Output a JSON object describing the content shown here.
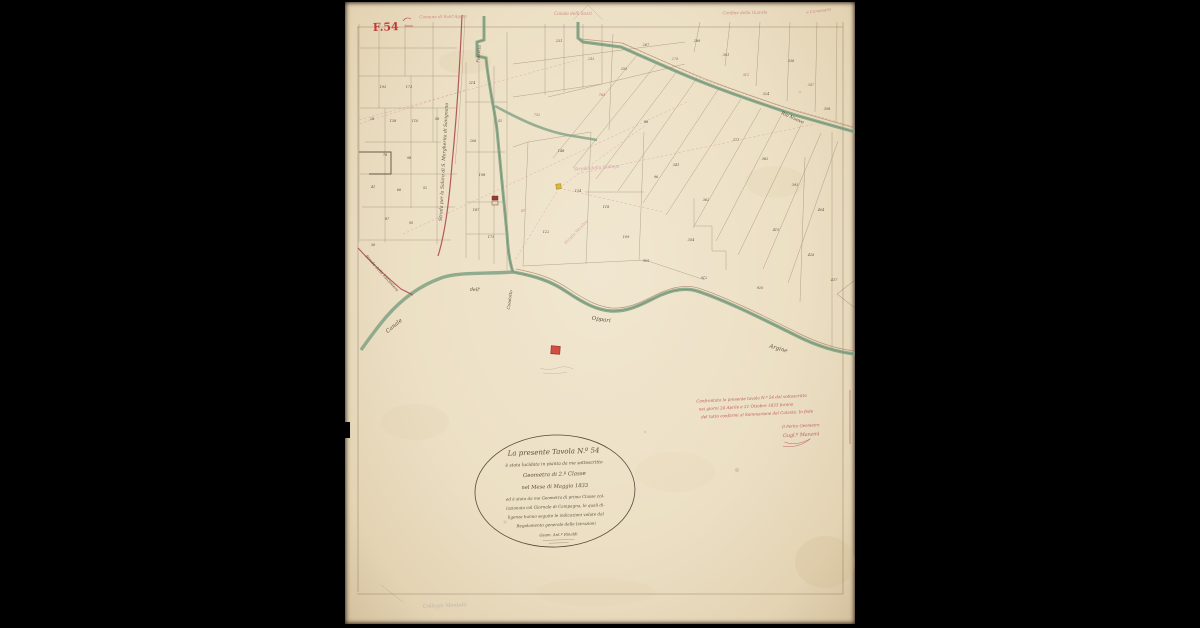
{
  "sheet": {
    "number_label": "F.54",
    "colors": {
      "paper": "#ece0c5",
      "canal": "#7fa184",
      "road": "#a84a52",
      "ink": "#473827",
      "note_red": "#b5484f",
      "pink": "#cf8f9e"
    }
  },
  "edge_notes": [
    "Comune di Sant'Agata",
    "Canale delli Sozzi",
    "Confine della Guarda",
    "e Campagna"
  ],
  "map_labels": {
    "road_salara": "Strada per la Salara di S. Margherita di Savignano",
    "fossetta": "Fossetta",
    "road_falconiera": "Strada della Falconiera",
    "canale": "Canale",
    "dell": "dell'",
    "condotto": "Condotto",
    "oppari": "Oppari",
    "argine": "Argine",
    "rio_nuovo": "Rio Nuovo",
    "gallega": "Strada della Gallega",
    "strada_vecchia": "Strada Vecchia",
    "pencil_note": "Collegio Montalti"
  },
  "parcel_numbers": [
    {
      "t": "193",
      "x": 38,
      "y": 86,
      "c": "k"
    },
    {
      "t": "173",
      "x": 64,
      "y": 86,
      "c": "k"
    },
    {
      "t": "28",
      "x": 27,
      "y": 118,
      "c": "k"
    },
    {
      "t": "138",
      "x": 48,
      "y": 120,
      "c": "k"
    },
    {
      "t": "110",
      "x": 70,
      "y": 120,
      "c": "k"
    },
    {
      "t": "58",
      "x": 92,
      "y": 118,
      "c": "k"
    },
    {
      "t": "78",
      "x": 40,
      "y": 154,
      "c": "k"
    },
    {
      "t": "98",
      "x": 64,
      "y": 157,
      "c": "k"
    },
    {
      "t": "41",
      "x": 28,
      "y": 186,
      "c": "k"
    },
    {
      "t": "66",
      "x": 54,
      "y": 189,
      "c": "k"
    },
    {
      "t": "52",
      "x": 80,
      "y": 187,
      "c": "k"
    },
    {
      "t": "87",
      "x": 42,
      "y": 218,
      "c": "k"
    },
    {
      "t": "95",
      "x": 66,
      "y": 222,
      "c": "k"
    },
    {
      "t": "36",
      "x": 28,
      "y": 244,
      "c": "k"
    },
    {
      "t": "214",
      "x": 127,
      "y": 82,
      "c": "k"
    },
    {
      "t": "206",
      "x": 128,
      "y": 140,
      "c": "k"
    },
    {
      "t": "198",
      "x": 137,
      "y": 174,
      "c": "k"
    },
    {
      "t": "187",
      "x": 131,
      "y": 209,
      "c": "k"
    },
    {
      "t": "175",
      "x": 146,
      "y": 236,
      "c": "k"
    },
    {
      "t": "752",
      "x": 192,
      "y": 114,
      "c": "r"
    },
    {
      "t": "148",
      "x": 216,
      "y": 150,
      "c": "k"
    },
    {
      "t": "134",
      "x": 233,
      "y": 190,
      "c": "k"
    },
    {
      "t": "122",
      "x": 201,
      "y": 231,
      "c": "k"
    },
    {
      "t": "118",
      "x": 261,
      "y": 206,
      "c": "k"
    },
    {
      "t": "109",
      "x": 281,
      "y": 236,
      "c": "k"
    },
    {
      "t": "96",
      "x": 311,
      "y": 176,
      "c": "k"
    },
    {
      "t": "88",
      "x": 301,
      "y": 121,
      "c": "k"
    },
    {
      "t": "763",
      "x": 257,
      "y": 94,
      "c": "r"
    },
    {
      "t": "231",
      "x": 214,
      "y": 40,
      "c": "k"
    },
    {
      "t": "243",
      "x": 246,
      "y": 58,
      "c": "r"
    },
    {
      "t": "255",
      "x": 279,
      "y": 68,
      "c": "k"
    },
    {
      "t": "267",
      "x": 301,
      "y": 44,
      "c": "k"
    },
    {
      "t": "278",
      "x": 330,
      "y": 58,
      "c": "r"
    },
    {
      "t": "289",
      "x": 352,
      "y": 40,
      "c": "k"
    },
    {
      "t": "301",
      "x": 381,
      "y": 54,
      "c": "k"
    },
    {
      "t": "312",
      "x": 401,
      "y": 74,
      "c": "r"
    },
    {
      "t": "324",
      "x": 421,
      "y": 93,
      "c": "k"
    },
    {
      "t": "336",
      "x": 446,
      "y": 60,
      "c": "k"
    },
    {
      "t": "347",
      "x": 466,
      "y": 84,
      "c": "r"
    },
    {
      "t": "358",
      "x": 482,
      "y": 108,
      "c": "k"
    },
    {
      "t": "371",
      "x": 391,
      "y": 139,
      "c": "k"
    },
    {
      "t": "382",
      "x": 420,
      "y": 158,
      "c": "k"
    },
    {
      "t": "393",
      "x": 450,
      "y": 184,
      "c": "k"
    },
    {
      "t": "404",
      "x": 476,
      "y": 209,
      "c": "k"
    },
    {
      "t": "415",
      "x": 431,
      "y": 229,
      "c": "k"
    },
    {
      "t": "426",
      "x": 466,
      "y": 254,
      "c": "k"
    },
    {
      "t": "437",
      "x": 489,
      "y": 279,
      "c": "k"
    },
    {
      "t": "362",
      "x": 361,
      "y": 199,
      "c": "k"
    },
    {
      "t": "354",
      "x": 346,
      "y": 239,
      "c": "k"
    },
    {
      "t": "341",
      "x": 331,
      "y": 164,
      "c": "k"
    },
    {
      "t": "920",
      "x": 415,
      "y": 287,
      "c": "k"
    },
    {
      "t": "912",
      "x": 359,
      "y": 277,
      "c": "k"
    },
    {
      "t": "905",
      "x": 301,
      "y": 260,
      "c": "k"
    },
    {
      "t": "45",
      "x": 155,
      "y": 120,
      "c": "r"
    },
    {
      "t": "57",
      "x": 178,
      "y": 210,
      "c": "r"
    }
  ],
  "cartouche": {
    "lines": [
      "La presente Tavola N.º 54",
      "è stata lucidata in pianta da me sottoscritto",
      "Geometra di 2.ª Classe",
      "nel Mese di Maggio 1833",
      "ed è stata da me Geometra di prima Classe col-",
      "lazionata col Giornale di Campagna, le quali di-",
      "ligenze hanno seguito le indicazioni volute dal",
      "Regolamento generale delle Istruzioni",
      "Geom. Ant.º Rinaldi"
    ]
  },
  "verification_note": {
    "lines": [
      "Confrontata la presente tavola N.º 54 dal sottoscritto",
      "nei giorni 24 Aprile e 21 Ottobre 1833 furono",
      "del tutto conformi al Sommarione del Catasto. In fede"
    ],
    "signature": [
      "Il Perito Geometra",
      "Gugl.º Manzini"
    ]
  }
}
